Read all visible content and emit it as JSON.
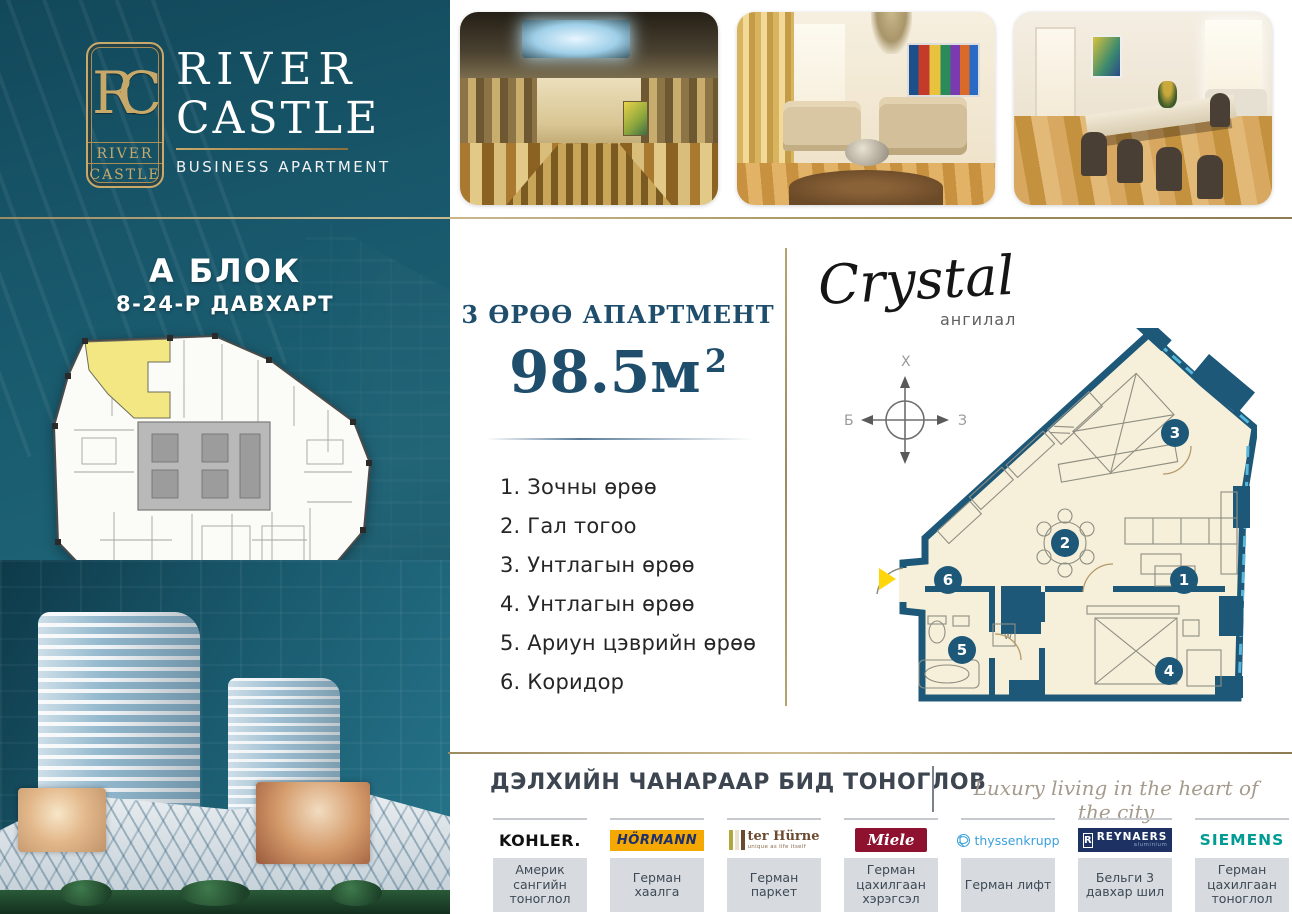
{
  "brand": {
    "monogram": "RC",
    "box_word1": "RIVER",
    "box_word2": "CASTLE",
    "title_line1": "RIVER",
    "title_line2": "CASTLE",
    "subtitle": "BUSINESS APARTMENT"
  },
  "left_panel": {
    "block_title": "А БЛОК",
    "block_subtitle": "8-24-Р ДАВХАРТ"
  },
  "apartment": {
    "type_label": "3 ӨРӨӨ АПАРТМЕНТ",
    "area_value": "98.5м",
    "area_sup": "2",
    "rooms": [
      "1. Зочны өрөө",
      "2. Гал тогоо",
      "3. Унтлагын өрөө",
      "4. Унтлагын өрөө",
      "5.  Ариун цэврийн өрөө",
      "6. Коридор"
    ]
  },
  "plan": {
    "class_name": "Crystal",
    "class_label": "ангилал",
    "compass": {
      "north": "Х",
      "west": "Б",
      "east": "З"
    },
    "room_numbers": [
      "1",
      "2",
      "3",
      "4",
      "5",
      "6"
    ],
    "washer_label": "W"
  },
  "footer": {
    "headline": "ДЭЛХИЙН ЧАНАРААР БИД ТОНОГЛОВ",
    "tagline": "Luxury living in the heart of the city",
    "brands": [
      {
        "name": "KOHLER.",
        "desc": "Америк сангийн тоноглол"
      },
      {
        "name": "HÖRMANN",
        "desc": "Герман хаалга"
      },
      {
        "name": "ter Hürne",
        "tagline": "unique as life itself",
        "desc": "Герман паркет"
      },
      {
        "name": "Miele",
        "desc": "Герман цахилгаан хэрэгсэл"
      },
      {
        "name": "thyssenkrupp",
        "desc": "Герман лифт"
      },
      {
        "name": "REYNAERS",
        "mark": "R",
        "sub": "aluminium",
        "desc": "Бельги 3 давхар шил"
      },
      {
        "name": "SIEMENS",
        "desc": "Герман цахилгаан тоноглол"
      }
    ]
  },
  "colors": {
    "teal_panel": "#19586c",
    "gold": "#b89a68",
    "plan_wall": "#1d5878",
    "plan_fill": "#f6efda",
    "highlight_yellow": "#f3e784",
    "arrow_yellow": "#ffd60a",
    "heading_blue": "#1f4e6d"
  }
}
